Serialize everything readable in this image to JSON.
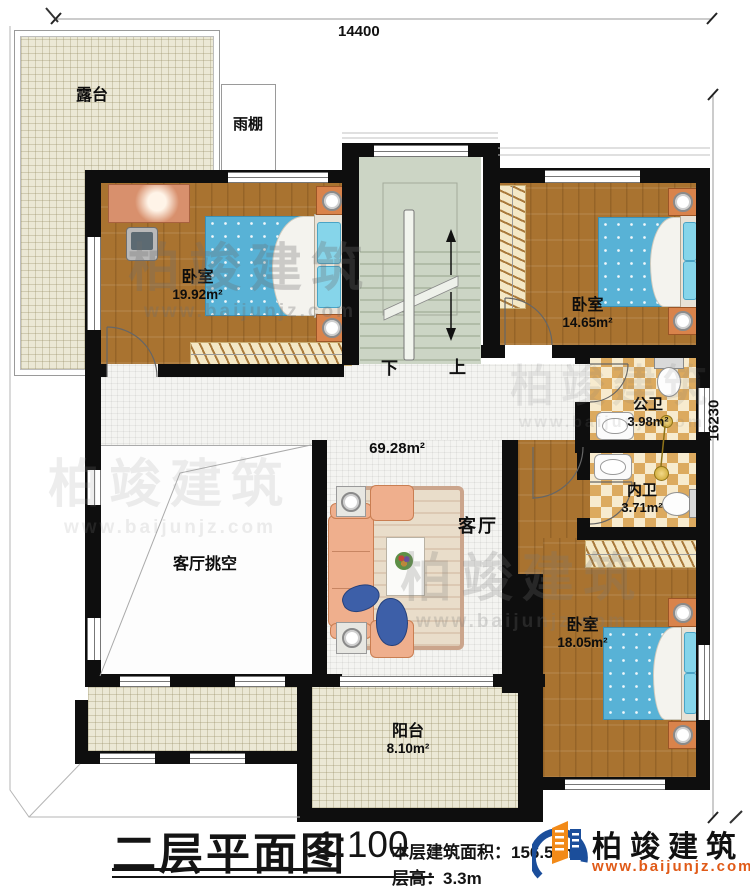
{
  "dimensions": {
    "width": "14400",
    "height": "16230"
  },
  "rooms": {
    "terrace": {
      "label": "露台"
    },
    "canopy": {
      "label": "雨棚"
    },
    "bedroom_nw": {
      "label": "卧室",
      "area": "19.92m²"
    },
    "bedroom_ne": {
      "label": "卧室",
      "area": "14.65m²"
    },
    "bath_public": {
      "label": "公卫",
      "area": "3.98m²"
    },
    "bath_ensuite": {
      "label": "内卫",
      "area": "3.71m²"
    },
    "bedroom_se": {
      "label": "卧室",
      "area": "18.05m²"
    },
    "living": {
      "label": "客厅",
      "area": "69.28m²"
    },
    "void": {
      "label": "客厅挑空"
    },
    "balcony": {
      "label": "阳台",
      "area": "8.10m²"
    }
  },
  "stairs": {
    "down_label": "下",
    "up_label": "上"
  },
  "title_block": {
    "title": "二层平面图",
    "scale": "1:100",
    "floor_area": "本层建筑面积：156.58m²",
    "floor_height": "层高：3.3m"
  },
  "brand": {
    "name": "柏竣建筑",
    "website": "www.baijunjz.com"
  },
  "watermark": {
    "text": "柏竣建筑",
    "website": "www.baijunjz.com"
  },
  "colors": {
    "wall": "#0e0e0e",
    "wood_floor": "#a97330",
    "bath_tile": "#dcaa5f",
    "mattress": "#58b2d6",
    "sofa": "#efaf8d",
    "logo_blue": "#1b4e9b",
    "logo_orange": "#f28a18",
    "url_orange": "#e05a17"
  }
}
